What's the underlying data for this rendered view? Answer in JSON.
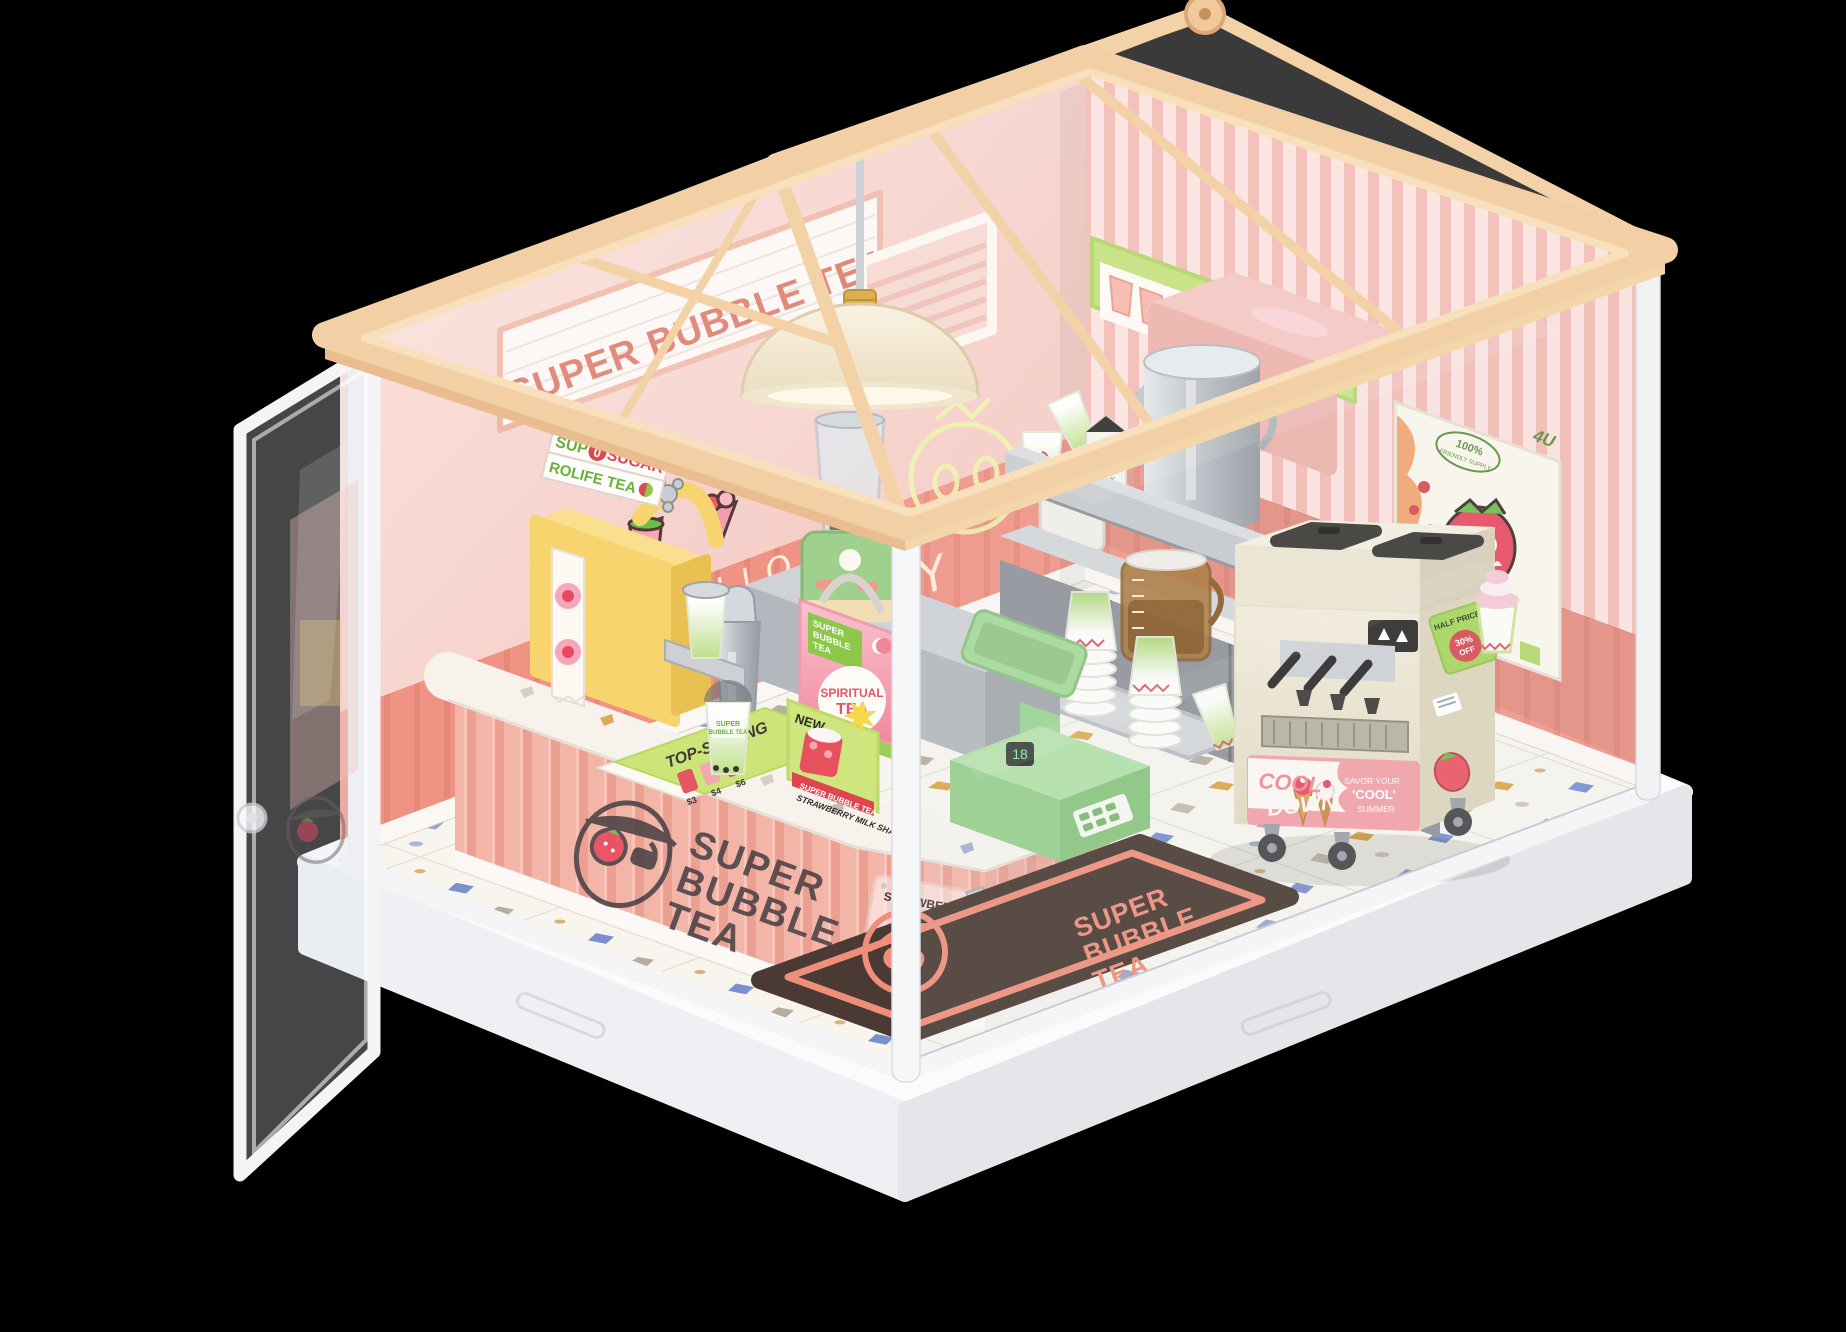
{
  "colors": {
    "background": "#000000",
    "wood": "#f2cfa4",
    "wood_light": "#f9e3c3",
    "wall_pink": "#f6c9c2",
    "wainscot_coral": "#ef9181",
    "stripe_pink": "#f3bcb6",
    "counter_pink": "#f4b5a9",
    "terrazzo": "#f8f4ee",
    "mint_green": "#9fd08e",
    "lime_green": "#a8d55e",
    "cream": "#efe8d6",
    "strawberry_red": "#e8495e",
    "stainless": "#c7cacf",
    "mat_brown": "#4a3a33",
    "mat_coral": "#ef8f7b",
    "base_white": "#fafafc"
  },
  "signboard": {
    "text": "SUPER BUBBLE TEA"
  },
  "neon": {
    "line1": "HELLO",
    "line2": "STRAWBERRY"
  },
  "sealer_sign": {
    "word1": "SUP",
    "zero": "0",
    "word2": "SUGAR",
    "line2": "ROLIFE TEA"
  },
  "gift_bag": {
    "patch_line1": "SUPER",
    "patch_line2": "BUBBLE",
    "patch_line3": "TEA",
    "title_line1": "SPIRITUAL",
    "title_line2": "TEA"
  },
  "bubble_tea_cup": {
    "brand_line1": "SUPER",
    "brand_line2": "BUBBLE TEA"
  },
  "flyer": {
    "title": "TOP-SELLING",
    "price1": "$3",
    "price2": "$4",
    "price3": "$6"
  },
  "new_card": {
    "badge": "NEW",
    "brand": "SUPER BUBBLE TEA",
    "product": "STRAWBERRY MILK SHAKE"
  },
  "plaque": {
    "quote_mark": "“",
    "title": "STRAWBERRY",
    "subtitle": "HAVE A CUP"
  },
  "milk_carton": {
    "line1": "SUPER",
    "line2": "MILK"
  },
  "menu_strip": {
    "price": "5.99"
  },
  "poster": {
    "corner_tag": "4U",
    "badge_percent": "100%",
    "badge_text": "FRIENDLY SUPPLY"
  },
  "cooldown_sticker": {
    "word1": "COOL",
    "word2": "DOWN",
    "side1": "SAVOR YOUR",
    "side2": "'COOL'",
    "side3": "SUMMER"
  },
  "promo_sticker": {
    "line1": "HALF PRICE",
    "percent": "30%",
    "off": "OFF"
  },
  "floor_mat": {
    "line1": "SUPER",
    "line2": "BUBBLE",
    "line3": "TEA"
  },
  "counter_logo": {
    "line1": "SUPER",
    "line2": "BUBBLE",
    "line3": "TEA"
  },
  "register_display": {
    "value": "18"
  }
}
